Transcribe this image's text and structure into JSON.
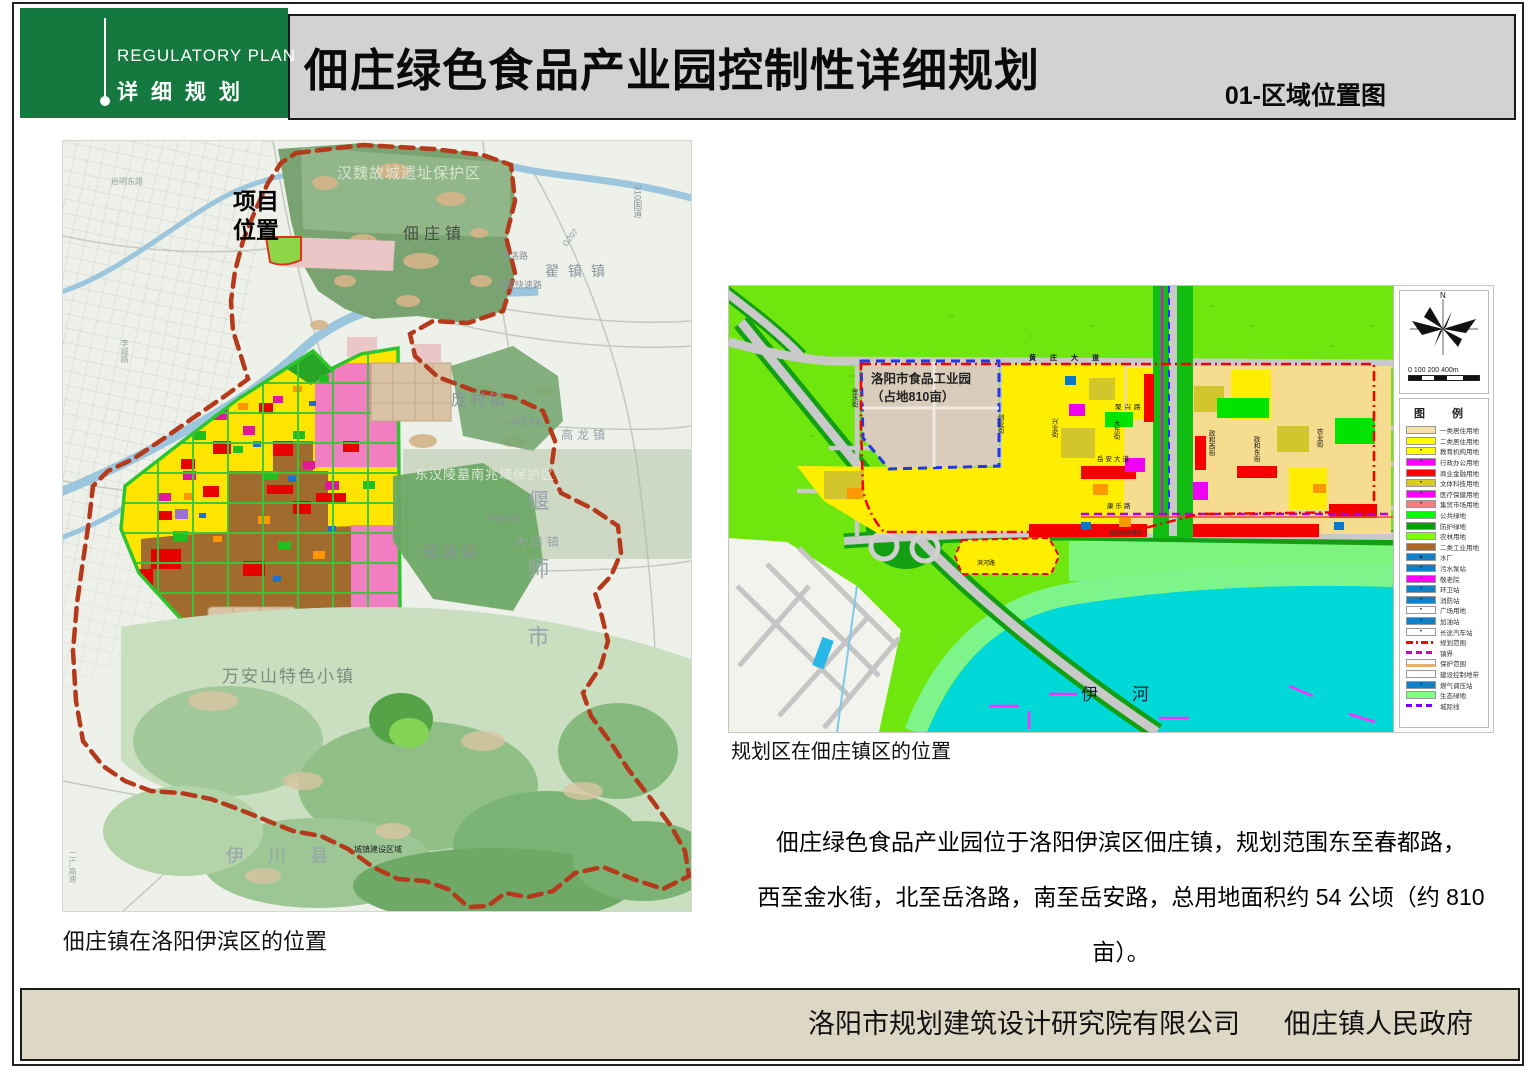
{
  "header": {
    "logo_en": "REGULATORY PLAN",
    "logo_cn": "详细规划",
    "title": "佃庄绿色食品产业园控制性详细规划",
    "sheet_no": "01-区域位置图"
  },
  "left_map": {
    "caption": "佃庄镇在洛阳伊滨区的位置",
    "labels": {
      "project_location": "项目位置",
      "hanwei_site": "汉魏故城遗址保护区",
      "dianzhuang_town": "佃庄镇",
      "zhaizhen_town": "翟镇镇",
      "yueluo_road": "岳洛路",
      "luoyan_expressway": "洛偃快速路",
      "pangcun_town": "庞村镇",
      "gaolong_town": "高龙镇",
      "donghan_tombs": "东汉陵墓南兆域保护区",
      "yanshi_city": "偃师市",
      "dakou_town": "大口镇",
      "koudian_town": "寇店镇",
      "wananshan_town": "万安山特色小镇",
      "yichuan_county": "伊川县",
      "town_construction_line": "城镇建设区域",
      "keji_avenue": "科技大道",
      "gaotie_avenue": "高铁大道",
      "g310": "310国道",
      "g207": "G207",
      "qiming_east_road": "启明东路",
      "licheng_road": "李城路",
      "erguang_expressway": "二广高速"
    }
  },
  "right_map": {
    "caption": "规划区在佃庄镇区的位置",
    "labels": {
      "industrial_park_line1": "洛阳市食品工业园",
      "industrial_park_line2": "（占地810亩）",
      "yi_river": "伊　　河",
      "huangzhuang_avenue": "黄庄大道",
      "juxing_road": "聚兴路",
      "yuean_avenue": "岳安大道",
      "kangle_road": "康乐路",
      "binhe_road": "滨河路",
      "intercity_expressway": "城际快速通道",
      "jinshui_street": "金水街",
      "chuangye_street": "创业街",
      "xingye_street": "兴业街",
      "dadong_street": "大东街",
      "zhenghe_west_street": "政和西街",
      "zhenghe_east_street": "政和东街",
      "nongye_street": "农业街"
    },
    "legend": {
      "title": "图　例",
      "north_label": "N",
      "scale_text": "0   100  200         400m",
      "items": [
        {
          "label": "一类居住用地",
          "kind": "fill",
          "color": "#F6DFA9"
        },
        {
          "label": "二类居住用地",
          "kind": "fill",
          "color": "#FFFF00"
        },
        {
          "label": "教育机构用地",
          "kind": "fill-sym",
          "color": "#FFFF00",
          "symbol": "•"
        },
        {
          "label": "行政办公用地",
          "kind": "fill-sym",
          "color": "#FF00FF",
          "symbol": "•"
        },
        {
          "label": "商业金融用地",
          "kind": "fill",
          "color": "#FF0000"
        },
        {
          "label": "文体科技用地",
          "kind": "fill-sym",
          "color": "#D8CC20",
          "symbol": "•"
        },
        {
          "label": "医疗保健用地",
          "kind": "fill-sym",
          "color": "#FF00FF",
          "symbol": "•"
        },
        {
          "label": "集贸市场用地",
          "kind": "fill-sym",
          "color": "#F08080",
          "symbol": "•"
        },
        {
          "label": "公共绿地",
          "kind": "fill",
          "color": "#00FF00"
        },
        {
          "label": "防护绿地",
          "kind": "fill",
          "color": "#00A000"
        },
        {
          "label": "农林用地",
          "kind": "fill",
          "color": "#7FFF00"
        },
        {
          "label": "二类工业用地",
          "kind": "fill",
          "color": "#A5682A"
        },
        {
          "label": "水厂",
          "kind": "fill-sym",
          "color": "#1080C8",
          "symbol": "▲"
        },
        {
          "label": "污水泵站",
          "kind": "fill-sym",
          "color": "#1080C8",
          "symbol": "•"
        },
        {
          "label": "敬老院",
          "kind": "fill-sym",
          "color": "#FF00FF",
          "symbol": "•"
        },
        {
          "label": "环卫站",
          "kind": "fill-sym",
          "color": "#1080C8",
          "symbol": "•"
        },
        {
          "label": "消防站",
          "kind": "fill-sym",
          "color": "#1080C8",
          "symbol": "•"
        },
        {
          "label": "广场用地",
          "kind": "fill-sym",
          "color": "#FFFFFF",
          "symbol": "•"
        },
        {
          "label": "加油站",
          "kind": "fill-sym",
          "color": "#1080C8",
          "symbol": "•"
        },
        {
          "label": "长途汽车站",
          "kind": "fill-sym",
          "color": "#FFFFFF",
          "symbol": "•"
        },
        {
          "label": "规划范围",
          "kind": "line-dashdot",
          "color": "#FF0000"
        },
        {
          "label": "镇界",
          "kind": "line-dash",
          "color": "#CC00CC"
        },
        {
          "label": "保护范围",
          "kind": "bar",
          "color": "#E8B070"
        },
        {
          "label": "建设控制地带",
          "kind": "outline",
          "color": "#FFFFFF"
        },
        {
          "label": "燃气调压站",
          "kind": "fill-sym",
          "color": "#1080C8",
          "symbol": "•"
        },
        {
          "label": "生态绿地",
          "kind": "fill",
          "color": "#80FF80"
        },
        {
          "label": "城际线",
          "kind": "line-dash",
          "color": "#8000FF"
        }
      ]
    }
  },
  "description": {
    "line1": "佃庄绿色食品产业园位于洛阳伊滨区佃庄镇，规划范围东至春都路，",
    "line2": "西至金水街，北至岳洛路，南至岳安路，总用地面积约 54 公顷（约 810 亩）。"
  },
  "footer": {
    "org1": "洛阳市规划建筑设计研究院有限公司",
    "org2": "佃庄镇人民政府"
  }
}
